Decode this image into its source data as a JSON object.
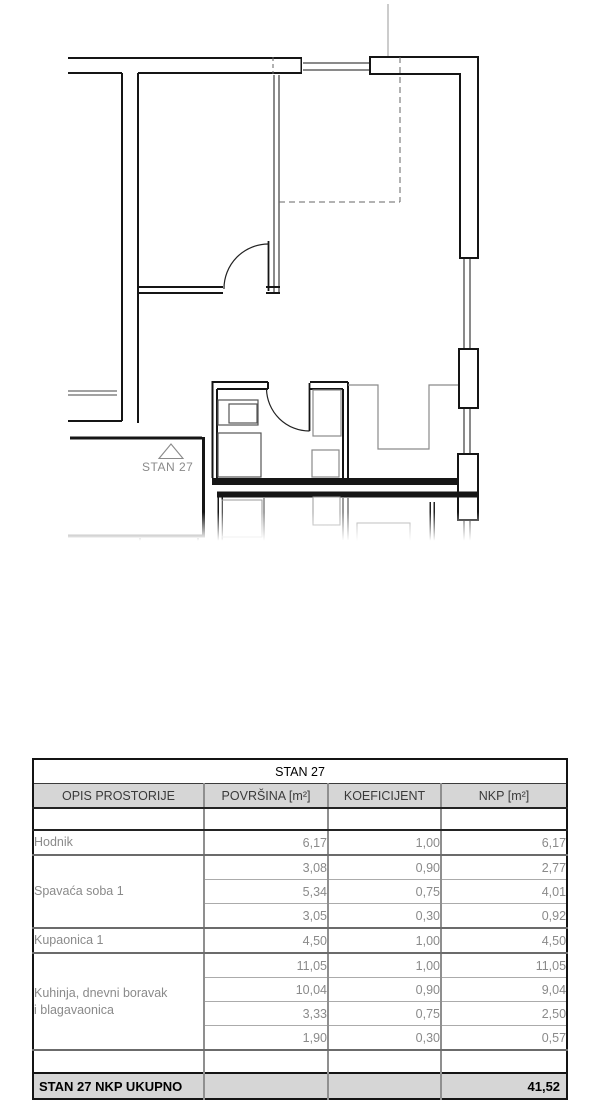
{
  "plan": {
    "apartment_label": "STAN 27",
    "entrance_marker_icon": "triangle-up-outline"
  },
  "table": {
    "title": "STAN 27",
    "headers": {
      "opis": "OPIS PROSTORIJE",
      "povrsina": "POVRŠINA [m²]",
      "koeficijent": "KOEFICIJENT",
      "nkp": "NKP [m²]"
    },
    "groups": [
      {
        "label": "Hodnik",
        "rows": [
          {
            "povrsina": "6,17",
            "koeficijent": "1,00",
            "nkp": "6,17"
          }
        ]
      },
      {
        "label": "Spavaća soba 1",
        "rows": [
          {
            "povrsina": "3,08",
            "koeficijent": "0,90",
            "nkp": "2,77"
          },
          {
            "povrsina": "5,34",
            "koeficijent": "0,75",
            "nkp": "4,01"
          },
          {
            "povrsina": "3,05",
            "koeficijent": "0,30",
            "nkp": "0,92"
          }
        ]
      },
      {
        "label": "Kupaonica 1",
        "rows": [
          {
            "povrsina": "4,50",
            "koeficijent": "1,00",
            "nkp": "4,50"
          }
        ]
      },
      {
        "label": "Kuhinja, dnevni boravak\ni blagavaonica",
        "rows": [
          {
            "povrsina": "11,05",
            "koeficijent": "1,00",
            "nkp": "11,05"
          },
          {
            "povrsina": "10,04",
            "koeficijent": "0,90",
            "nkp": "9,04"
          },
          {
            "povrsina": "3,33",
            "koeficijent": "0,75",
            "nkp": "2,50"
          },
          {
            "povrsina": "1,90",
            "koeficijent": "0,30",
            "nkp": "0,57"
          }
        ]
      }
    ],
    "total": {
      "label": "STAN 27 NKP UKUPNO",
      "nkp": "41,52"
    }
  },
  "colors": {
    "wall": "#151515",
    "furniture_gray": "#8a8a8a",
    "table_header_bg": "#d6d6d6",
    "table_total_bg": "#d6d6d6",
    "muted_text": "#8a8a8a"
  }
}
